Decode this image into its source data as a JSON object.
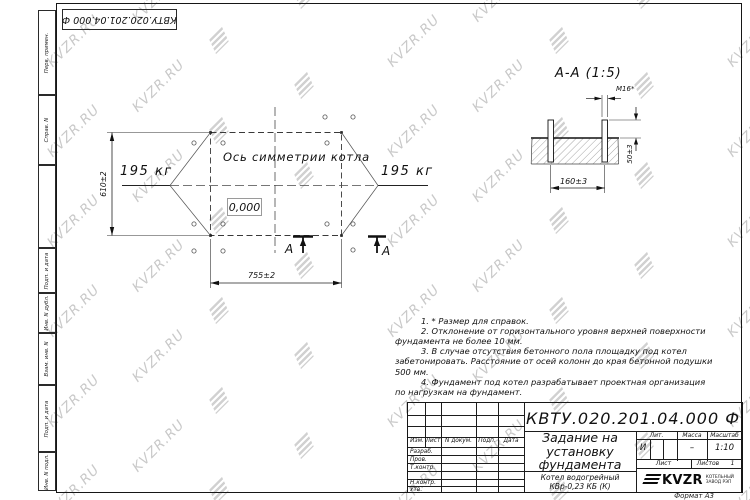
{
  "doc": {
    "number": "КВТУ.020.201.04.000 Ф",
    "title": "Задание на установку фундамента",
    "product": "Котел водогрейный КВр-0,23 КБ (К)",
    "format_note": "Формат А3"
  },
  "watermark": {
    "text": "KVZR.RU",
    "color": "#c9c9c9"
  },
  "margin_boxes": {
    "perv_primen": "Перв. примен.",
    "sprav_n": "Справ. N",
    "podp_data_1": "Подп. и дата",
    "inv_dubl": "Инв. N дубл.",
    "vzam_inv": "Взам. инв. N",
    "podp_data_2": "Подп. и дата",
    "inv_podl": "Инв. N подл."
  },
  "title_block": {
    "cols": {
      "izm": "Изм.",
      "list": "Лист",
      "docum": "N докум.",
      "podp": "Подп.",
      "data": "Дата"
    },
    "rows": {
      "razrab": "Разраб.",
      "prov": "Пров.",
      "tkontr": "Т.контр.",
      "nkontr": "Н.контр.",
      "utv": "Утв."
    },
    "lit_label": "Лит.",
    "lit_value": "И",
    "massa_label": "Масса",
    "massa_value": "–",
    "masshtab_label": "Масштаб",
    "masshtab_value": "1:10",
    "list_label": "Лист",
    "listov_label": "Листов",
    "listov_value": "1",
    "logo_text": "KVZR",
    "logo_caption_line1": "КОТЕЛЬНЫЙ",
    "logo_caption_line2": "ЗАВОД РЭП"
  },
  "plan": {
    "axis_label": "Ось симметрии котла",
    "elevation": "0,000",
    "weight_left": "195 кг",
    "weight_right": "195 кг",
    "dim_height": "610±2",
    "dim_width": "755±2",
    "section_letter_left": "А",
    "section_letter_right": "А"
  },
  "section": {
    "title": "А-А (1:5)",
    "thread_label": "М16*",
    "dim_spacing": "160±3",
    "dim_protrusion": "50±3"
  },
  "notes": {
    "n1": "1. * Размер для справок.",
    "n2": "2. Отклонение от горизонтального уровня верхней поверхности фундамента не более 10 мм.",
    "n3": "3. В случае отсутствия бетонного пола площадку под котел забетонировать. Расстояние от осей колонн до края бетонной подушки 500 мм.",
    "n4": "4. Фундамент под котел разрабатывает проектная организация по нагрузкам на фундамент."
  }
}
